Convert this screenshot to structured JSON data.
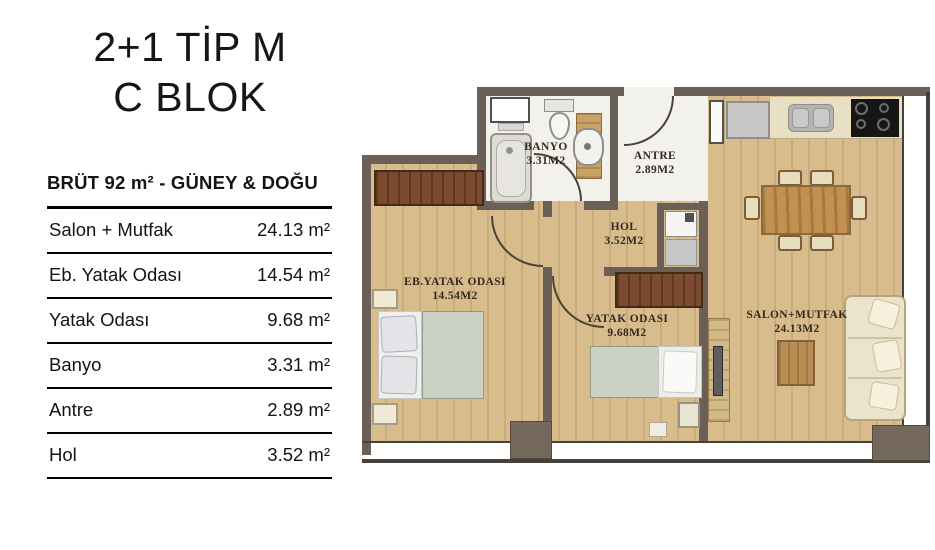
{
  "title": {
    "line1": "2+1 TİP M",
    "line2": "C BLOK"
  },
  "summary_header": "BRÜT 92 m²  - GÜNEY & DOĞU",
  "area_table": {
    "rows": [
      {
        "label": "Salon + Mutfak",
        "value": "24.13 m²"
      },
      {
        "label": "Eb. Yatak Odası",
        "value": "14.54 m²"
      },
      {
        "label": "Yatak Odası",
        "value": "9.68 m²"
      },
      {
        "label": "Banyo",
        "value": "3.31 m²"
      },
      {
        "label": "Antre",
        "value": "2.89 m²"
      },
      {
        "label": "Hol",
        "value": "3.52 m²"
      }
    ]
  },
  "floor_plan": {
    "rooms": [
      {
        "id": "salon-mutfak",
        "name": "SALON+MUTFAK",
        "area": "24.13M2"
      },
      {
        "id": "eb-yatak-odasi",
        "name": "EB.YATAK ODASI",
        "area": "14.54M2"
      },
      {
        "id": "yatak-odasi",
        "name": "YATAK ODASI",
        "area": "9.68M2"
      },
      {
        "id": "banyo",
        "name": "BANYO",
        "area": "3.31M2"
      },
      {
        "id": "antre",
        "name": "ANTRE",
        "area": "2.89M2"
      },
      {
        "id": "hol",
        "name": "HOL",
        "area": "3.52M2"
      }
    ]
  },
  "colors": {
    "wall": "#6a6057",
    "floor": "#d8bc8c",
    "bath_floor": "#f3f1ec",
    "wardrobe": "#7b4a2f",
    "bedding": "#c9d2c3",
    "sofa": "#ece3cc",
    "wood": "#c09150",
    "counter": "#e9dfc2",
    "appliance": "#c6c6c4",
    "stove": "#161616",
    "label_text": "#33291f"
  }
}
